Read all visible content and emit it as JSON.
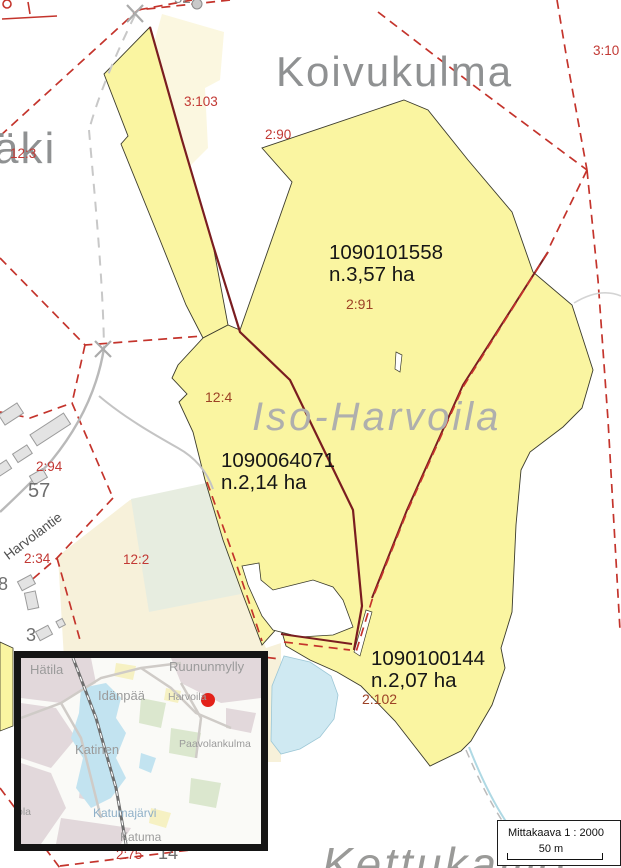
{
  "main_map": {
    "place_names": {
      "koivukulma": "Koivukulma",
      "aki_partial": "äki",
      "iso_harvoila": "Iso-Harvoila",
      "kettukallio": "Kettukallio",
      "road": "Harvolantie",
      "top_partial": "52"
    },
    "parcels": [
      {
        "id": "1090101558",
        "area": "n.3,57 ha",
        "unit": "2:91"
      },
      {
        "id": "1090064071",
        "area": "n.2,14 ha",
        "unit": "12:4"
      },
      {
        "id": "1090100144",
        "area": "n.2,07 ha",
        "unit": "2:102"
      }
    ],
    "unit_labels": [
      {
        "text": "3:103"
      },
      {
        "text": "2:90"
      },
      {
        "text": "12:3"
      },
      {
        "text": "3:10"
      },
      {
        "text": "2:94"
      },
      {
        "text": "2:34"
      },
      {
        "text": "12:2"
      },
      {
        "text": "2:75"
      }
    ],
    "house_numbers": [
      {
        "text": "57"
      },
      {
        "text": "8"
      },
      {
        "text": "3"
      },
      {
        "text": "14"
      }
    ]
  },
  "inset_map": {
    "places": [
      {
        "name": "Hätila"
      },
      {
        "name": "Ruununmylly"
      },
      {
        "name": "Idänpää"
      },
      {
        "name": "Harvoila"
      },
      {
        "name": "Paavolankulma"
      },
      {
        "name": "Katinen"
      },
      {
        "name": "Katuma"
      },
      {
        "name": "ola"
      }
    ],
    "lake_name": "Katumajärvi"
  },
  "scale_box": {
    "title": "Mittakaava  1 : 2000",
    "distance_label": "50 m"
  },
  "colors": {
    "parcel_yellow": "#FAF5A1",
    "parcel_cream": "#FBF7E0",
    "area_cream": "#F7F1DA",
    "field_green": "#E7EDE0",
    "water_blue": "#CFE9F2",
    "boundary_maroon": "#7A1D20",
    "boundary_red_dashed": "#C4342C",
    "road_gray": "#B9B9B9",
    "label_red": "#C23934",
    "label_brown": "#9C4226",
    "place_gray": "#8F9192",
    "marker_red": "#E32119"
  }
}
